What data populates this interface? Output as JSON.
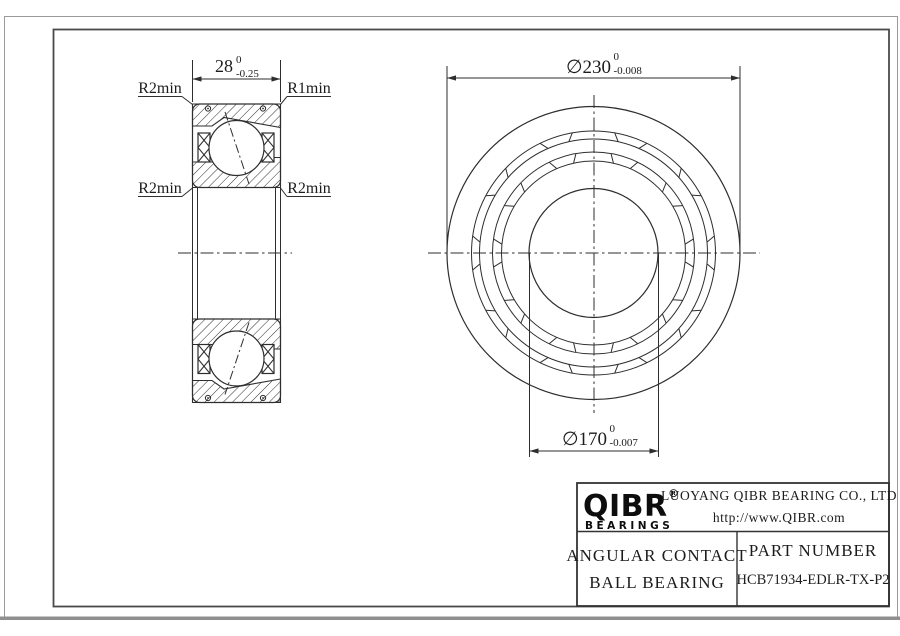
{
  "section_view": {
    "width_dim": {
      "value": "28",
      "tol_upper": "0",
      "tol_lower": "-0.25"
    },
    "labels": {
      "top_left": "R2min",
      "top_right": "R1min",
      "bottom_left": "R2min",
      "bottom_right": "R2min"
    }
  },
  "front_view": {
    "outer_dia": {
      "value": "∅230",
      "tol_upper": "0",
      "tol_lower": "-0.008"
    },
    "bore_dia": {
      "value": "∅170",
      "tol_upper": "0",
      "tol_lower": "-0.007"
    }
  },
  "title_block": {
    "brand": "QIBR",
    "registered": "®",
    "brand_sub": "BEARINGS",
    "company": "LUOYANG QIBR BEARING CO., LTD",
    "website": "http://www.QIBR.com",
    "product_line1": "ANGULAR CONTACT",
    "product_line2": "BALL BEARING",
    "part_number_label": "PART NUMBER",
    "part_number": "HCB71934-EDLR-TX-P2"
  },
  "colors": {
    "line": "#2e2e2e",
    "text": "#1c1c1c",
    "frame": "#8f8f8f"
  }
}
